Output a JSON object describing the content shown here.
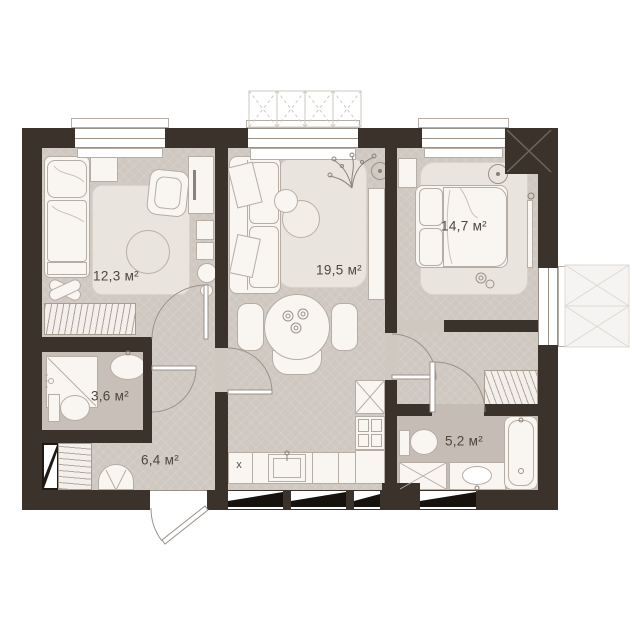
{
  "floor_plan": {
    "rooms": [
      {
        "id": "child-bedroom",
        "area": "12,3 м²"
      },
      {
        "id": "living-room",
        "area": "19,5 м²"
      },
      {
        "id": "bedroom",
        "area": "14,7 м²"
      },
      {
        "id": "shower-room",
        "area": "3,6 м²"
      },
      {
        "id": "hallway",
        "area": "6,4 м²"
      },
      {
        "id": "bathroom",
        "area": "5,2 м²"
      }
    ],
    "stove_marker": "х",
    "colors": {
      "walls": "#3a322b",
      "floor": "#cfc8c1",
      "bathroom_floor": "#c8c0b8",
      "furniture": "#f9f5f1",
      "background": "#ffffff"
    }
  }
}
